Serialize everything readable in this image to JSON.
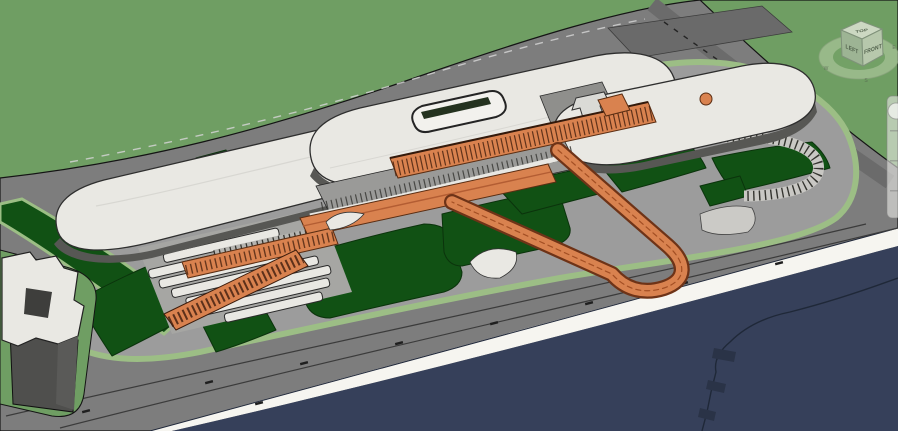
{
  "viewcube": {
    "top": "TOP",
    "front": "FRONT",
    "left": "LEFT",
    "compass_west": "W",
    "compass_south": "S",
    "compass_east": "E"
  },
  "nav_bar": {
    "icon": "steering-wheel-icon"
  },
  "colors": {
    "terrain": "#6f9e63",
    "terrain_light": "#9cbe85",
    "road": "#7d7d7d",
    "road_dark": "#6a6a6a",
    "plaza": "#9c9c9c",
    "lawn": "#115114",
    "water": "#36405a",
    "seawall": "#f6f5f0",
    "roof_white": "#e9e8e3",
    "roof_shade": "#d2d1cc",
    "wall_dark": "#575754",
    "wall_mid": "#6e6e6e",
    "orange": "#d9824f",
    "orange_dark": "#b35d33",
    "outline": "#1c1c1c"
  }
}
